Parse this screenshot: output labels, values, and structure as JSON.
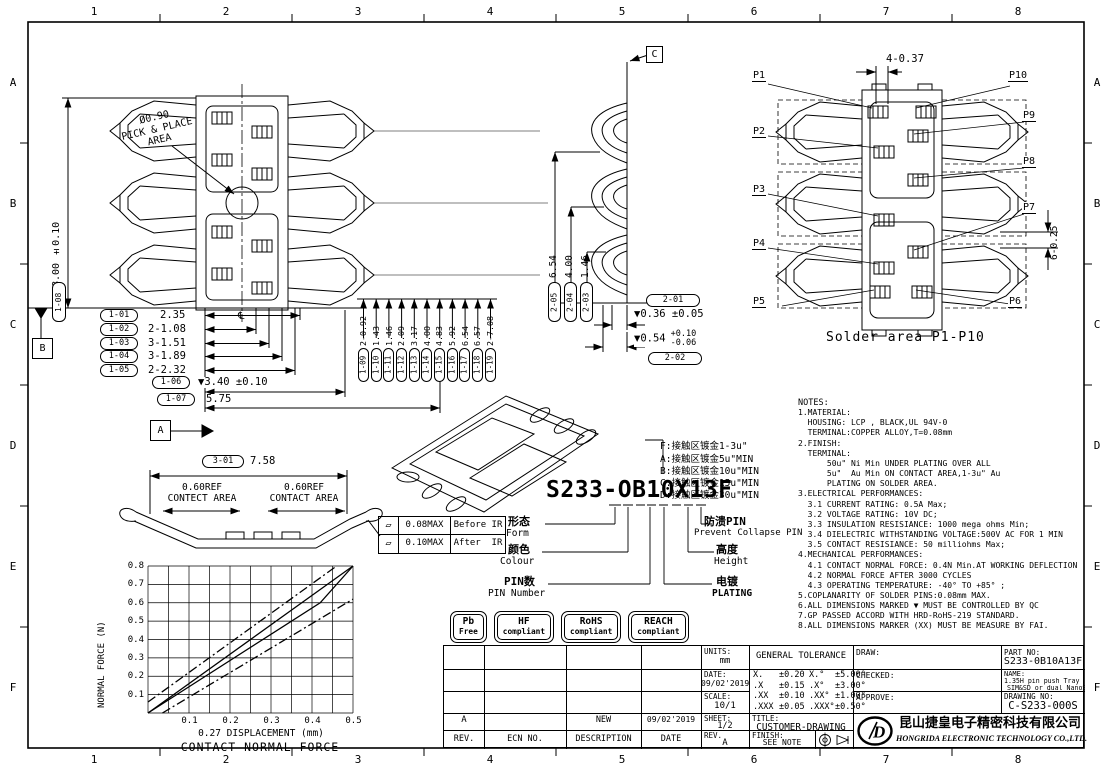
{
  "zones": {
    "cols": [
      "1",
      "2",
      "3",
      "4",
      "5",
      "6",
      "7",
      "8"
    ],
    "rows": [
      "A",
      "B",
      "C",
      "D",
      "E",
      "F"
    ]
  },
  "front_view": {
    "dim_vertical": {
      "id": "1-08",
      "value": "▼8.00 ±0.10"
    },
    "pick_place": {
      "line1": "Ø0.90",
      "line2": "PICK & PLACE",
      "line3": "AREA"
    },
    "centerline_symbol": "℄",
    "datum_b": "B",
    "datum_a": "A",
    "section_c": "C",
    "callouts_left": [
      {
        "id": "1-01",
        "value": "2.35"
      },
      {
        "id": "1-02",
        "value": "2-1.08"
      },
      {
        "id": "1-03",
        "value": "3-1.51"
      },
      {
        "id": "1-04",
        "value": "3-1.89"
      },
      {
        "id": "1-05",
        "value": "2-2.32"
      },
      {
        "id": "1-06",
        "value": "▼3.40 ±0.10"
      },
      {
        "id": "1-07",
        "value": "5.75"
      }
    ],
    "callouts_bottom": [
      {
        "id": "1-09",
        "value": "2-0.92"
      },
      {
        "id": "1-10",
        "value": "1.43"
      },
      {
        "id": "1-11",
        "value": "1.46"
      },
      {
        "id": "1-12",
        "value": "2.09"
      },
      {
        "id": "1-13",
        "value": "3.17"
      },
      {
        "id": "1-14",
        "value": "4.00"
      },
      {
        "id": "1-15",
        "value": "4.83"
      },
      {
        "id": "1-16",
        "value": "5.92"
      },
      {
        "id": "1-17",
        "value": "6.54"
      },
      {
        "id": "1-18",
        "value": "6.57"
      },
      {
        "id": "1-19",
        "value": "2-7.08"
      }
    ]
  },
  "section_view": {
    "stack": [
      {
        "id": "2-05",
        "value": "6.54"
      },
      {
        "id": "2-04",
        "value": "4.00"
      },
      {
        "id": "2-03",
        "value": "1.46"
      }
    ],
    "callout_2_01": "2-01",
    "dim_2_01": "▼0.36 ±0.05",
    "dim_2_02": {
      "value": "▼0.54",
      "tol_plus": "+0.10",
      "tol_minus": "-0.06"
    },
    "callout_2_02": "2-02"
  },
  "solder_view": {
    "dim_top": "4-0.37",
    "dim_right": "6-0.25",
    "pins_left": [
      "P1",
      "P2",
      "P3",
      "P4",
      "P5"
    ],
    "pins_right": [
      "P10",
      "P9",
      "P8",
      "P7",
      "P6"
    ],
    "caption": "Solder area P1-P10"
  },
  "profile_view": {
    "callout": "3-01",
    "dim": "7.58",
    "left_line1": "0.60REF",
    "left_line2": "CONTECT AREA",
    "right_line1": "0.60REF",
    "right_line2": "CONTACT AREA",
    "flatness": [
      {
        "symbol": "▱",
        "value": "0.08MAX",
        "stage": "Before IR"
      },
      {
        "symbol": "▱",
        "value": "0.10MAX",
        "stage": "After  IR"
      }
    ]
  },
  "part_code": {
    "number": "S233-OB10X13F",
    "plating_options": [
      "F:接触区镀金1-3u\"",
      "A:接触区镀金5u\"MIN",
      "B:接触区镀金10u\"MIN",
      "C:接触区镀金15u\"MIN",
      "D:接触区镀金30u\"MIN"
    ],
    "form_cn": "形态",
    "form_en": "Form",
    "colour_cn": "颜色",
    "colour_en": "Colour",
    "pin_cn": "PIN数",
    "pin_en": "PIN Number",
    "prevent_cn": "防溃PIN",
    "prevent_en": "Prevent Collapse PIN",
    "height_cn": "高度",
    "height_en": "Height",
    "plating_cn": "电镀",
    "plating_en": "PLATING"
  },
  "badges": [
    {
      "line1": "Pb",
      "line2": "Free"
    },
    {
      "line1": "HF",
      "line2": "compliant"
    },
    {
      "line1": "RoHS",
      "line2": "compliant"
    },
    {
      "line1": "REACH",
      "line2": "compliant"
    }
  ],
  "notes": {
    "title": "NOTES:",
    "lines": [
      "1.MATERIAL:",
      "  HOUSING: LCP , BLACK,UL 94V-0",
      "  TERMINAL:COPPER ALLOY,T=0.08mm",
      "2.FINISH:",
      "  TERMINAL:",
      "      50u\" Ni Min UNDER PLATING OVER ALL",
      "      5u\"  Au Min ON CONTACT AREA,1-3u\" Au",
      "      PLATING ON SOLDER AREA.",
      "3.ELECTRICAL PERFORMANCES:",
      "  3.1 CURRENT RATING: 0.5A Max;",
      "  3.2 VOLTAGE RATING: 10V DC;",
      "  3.3 INSULATION RESISIANCE: 1000 mega ohms Min;",
      "  3.4 DIELECTRIC WITHSTANDING VOLTAGE:500V AC FOR 1 MIN",
      "  3.5 CONTACT RESISIANCE: 50 milliohms Max;",
      "4.MECHANICAL PERFORMANCES:",
      "  4.1 CONTACT NORMAL FORCE: 0.4N Min.AT WORKING DEFLECTION",
      "  4.2 NORMAL FORCE AFTER 3000 CYCLES",
      "  4.3 OPERATING TEMPERATURE: -40° TO +85° ;",
      "5.COPLANARITY OF SOLDER PINS:0.08mm MAX.",
      "6.ALL DIMENSIONS MARKED ▼ MUST BE CONTROLLED BY QC",
      "7.GP PASSED ACCORD WITH HRD-RoHS-219 STANDARD.",
      "8.ALL DIMENSIONS MARKER (XX) MUST BE MEASURE BY FAI."
    ]
  },
  "chart_data": {
    "type": "line",
    "title": "CONTACT NORMAL FORCE",
    "xlabel": "0.27 DISPLACEMENT (mm)",
    "ylabel": "NORMAL FORCE (N)",
    "xlim": [
      0,
      0.5
    ],
    "ylim": [
      0,
      0.8
    ],
    "xgrid_step": 0.05,
    "ygrid_step": 0.1,
    "grid": true,
    "legend": false,
    "xticks": [
      0.1,
      0.2,
      0.3,
      0.4,
      0.5
    ],
    "yticks_desc": [
      0.8,
      0.7,
      0.6,
      0.5,
      0.4,
      0.3,
      0.2,
      0.1
    ],
    "series": [
      {
        "name": "upper tolerance",
        "style": "dashdot",
        "x": [
          0,
          0.46
        ],
        "y": [
          0.06,
          0.8
        ]
      },
      {
        "name": "nominal load",
        "style": "solid",
        "x": [
          0,
          0.5
        ],
        "y": [
          0,
          0.8
        ]
      },
      {
        "name": "nominal unload",
        "style": "solid",
        "x": [
          0,
          0.42,
          0.5
        ],
        "y": [
          0,
          0.6,
          0.8
        ]
      },
      {
        "name": "lower tolerance",
        "style": "dashdot",
        "x": [
          0.035,
          0.5
        ],
        "y": [
          0,
          0.62
        ]
      }
    ]
  },
  "revision_table": {
    "headers": [
      "REV.",
      "ECN NO.",
      "DESCRIPTION",
      "DATE"
    ],
    "row": {
      "rev": "A",
      "ecn": "",
      "description": "NEW",
      "date": "09/02'2019"
    }
  },
  "title_block": {
    "units_label": "UNITS:",
    "units": "mm",
    "tol_title": "GENERAL TOLERANCE",
    "tolerances": [
      {
        "s": "X.",
        "v": "±0.20",
        "sa": "X.°",
        "va": "±5.00°"
      },
      {
        "s": ".X",
        "v": "±0.15",
        "sa": ".X°",
        "va": "±3.00°"
      },
      {
        "s": ".XX",
        "v": "±0.10",
        "sa": ".XX°",
        "va": "±1.00°"
      },
      {
        "s": ".XXX",
        "v": "±0.05",
        "sa": ".XXX°",
        "va": "±0.50°"
      }
    ],
    "date_label": "DATE:",
    "date": "09/02'2019",
    "scale_label": "SCALE:",
    "scale": "10/1",
    "sheet_label": "SHEET:",
    "sheet": "1/2",
    "rev_label": "REV.",
    "rev": "A",
    "title_label": "TITLE:",
    "title": "CUSTOMER-DRAWING",
    "finish_label": "FINISH:",
    "finish": "SEE NOTE",
    "draw_label": "DRAW:",
    "checked_label": "CHECKED:",
    "approve_label": "APPROVE:",
    "part_label": "PART NO:",
    "part_no": "S233-0B10A13F",
    "name_label": "NAME:",
    "name1": "1.35H pin push Tray type Nano",
    "name2": "SIM&SD or dual NanoSIM conn.",
    "dwg_label": "DRAWING NO:",
    "dwg_no": "C-S233-000S",
    "logo_letter": "D",
    "company_cn": "昆山捷皇电子精密科技有限公司",
    "company_en": "HONGRIDA ELECTRONIC TECHNOLOGY CO.,LTD."
  }
}
